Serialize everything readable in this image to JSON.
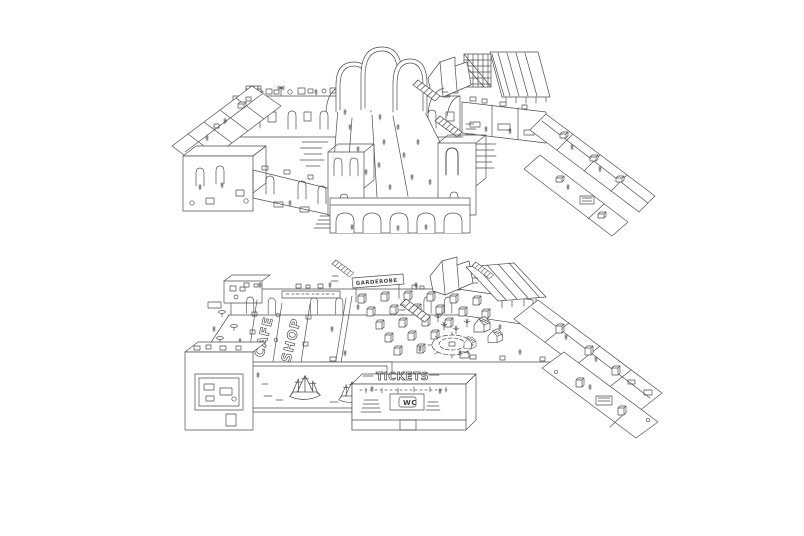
{
  "canvas": {
    "background": "#ffffff",
    "ink_color": "#4f4f4f"
  },
  "illustration": {
    "type": "hand-drawn isometric cutaway floor plans, two levels",
    "ground_level": {
      "garderobe_sign": "GARDEROBE",
      "cafe_floor_text": "CAFE",
      "shop_floor_text": "SHOP",
      "tickets_text": "TICKETS",
      "wc_text": "WC"
    }
  }
}
